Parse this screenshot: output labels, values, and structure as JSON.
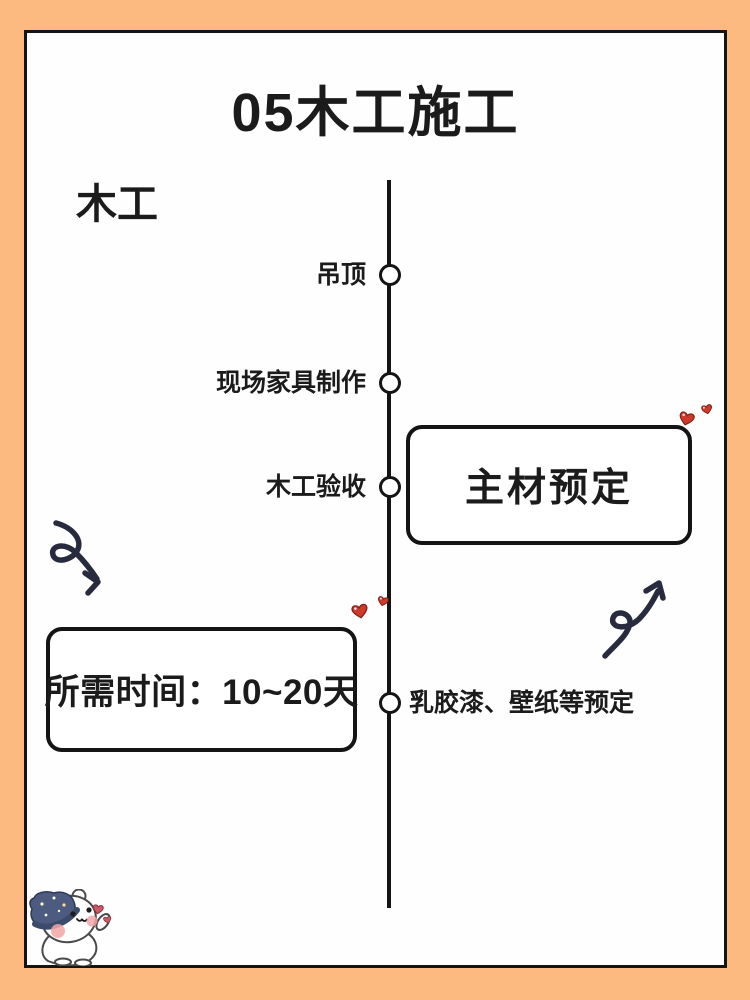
{
  "header": {
    "title": "05木工施工",
    "category": "木工"
  },
  "timeline": {
    "items": [
      {
        "label": "吊顶",
        "side": "left"
      },
      {
        "label": "现场家具制作",
        "side": "left"
      },
      {
        "label": "木工验收",
        "side": "left"
      },
      {
        "label": "乳胶漆、壁纸等预定",
        "side": "right"
      }
    ]
  },
  "boxes": {
    "main_material": "主材预定",
    "duration": "所需时间：10~20天"
  },
  "icons": {
    "arrow_left": "curly-arrow-down-right-icon",
    "arrow_right": "curly-arrow-up-right-icon",
    "hearts": "heart-icon",
    "mascot": "bear-wizard-hat-mascot"
  },
  "colors": {
    "frame": "#FCBA80",
    "card": "#FEFEFE",
    "ink": "#141414",
    "arrow_ink": "#272B3D",
    "heart_red": "#CD3A2C",
    "heart_outline": "#801F16",
    "hat_navy": "#4D5B80",
    "blush_pink": "#F2A6A6"
  }
}
